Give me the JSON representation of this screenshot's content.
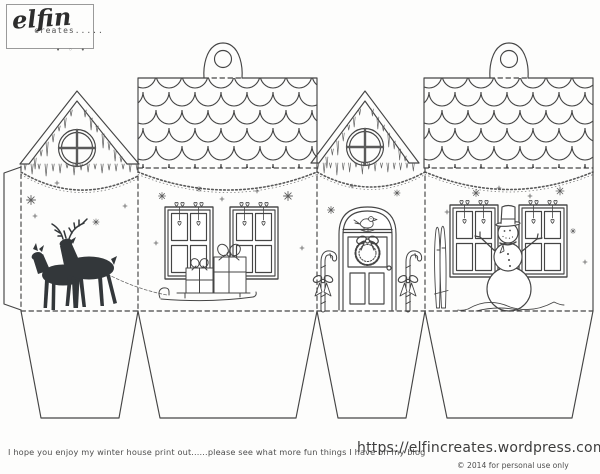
{
  "logo": {
    "name": "elfin",
    "tagline": "creates.....",
    "marks": "• ◦ •"
  },
  "footer": {
    "note": "I hope you enjoy my winter house print out......please see what more fun things I have on my blog",
    "url": "https://elfincreates.wordpress.com",
    "license": "© 2014  for personal use only"
  },
  "colors": {
    "ink": "#454545",
    "deer_silhouette": "#33373a",
    "paper": "#fdfdfc",
    "logo_border": "#9a9a9a",
    "footer_text": "#4e4e4e"
  },
  "sheet": {
    "kind": "fold-up winter house gift box template",
    "panels": [
      {
        "scene": "reindeer-pair-silhouette",
        "roof": "gable-with-icicles-round-window"
      },
      {
        "scene": "presents-on-sleigh-two-windows",
        "roof": "scalloped-shingles-hang-tab"
      },
      {
        "scene": "front-door-wreath-bird-candy-canes",
        "roof": "gable-with-icicles-round-window"
      },
      {
        "scene": "snowman-with-skis-two-windows",
        "roof": "scalloped-shingles-hang-tab"
      }
    ],
    "hang_tabs": 2,
    "base_flaps": 4
  }
}
